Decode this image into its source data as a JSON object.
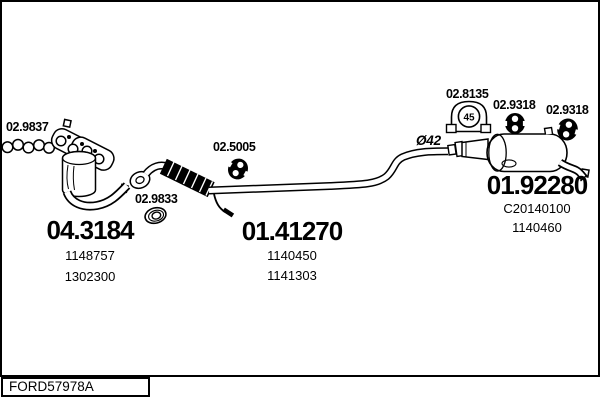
{
  "drawing": {
    "footer_code": "FORD57978A",
    "labels": {
      "manifold_gasket": "02.9837",
      "ring_gasket": "02.9833",
      "center_hanger": "02.5005",
      "clamp": "02.8135",
      "clamp_size": "45",
      "hanger_front": "02.9318",
      "hanger_rear": "02.9318",
      "pipe_diameter": "Ø42"
    },
    "parts": {
      "catalytic_converter": {
        "code": "04.3184",
        "refs": [
          "1148757",
          "1302300"
        ]
      },
      "center_pipe": {
        "code": "01.41270",
        "refs": [
          "1140450",
          "1141303"
        ]
      },
      "rear_silencer": {
        "code": "01.92280",
        "refs": [
          "C20140100",
          "1140460"
        ]
      }
    },
    "colors": {
      "ink": "#000000",
      "background": "#ffffff"
    }
  }
}
